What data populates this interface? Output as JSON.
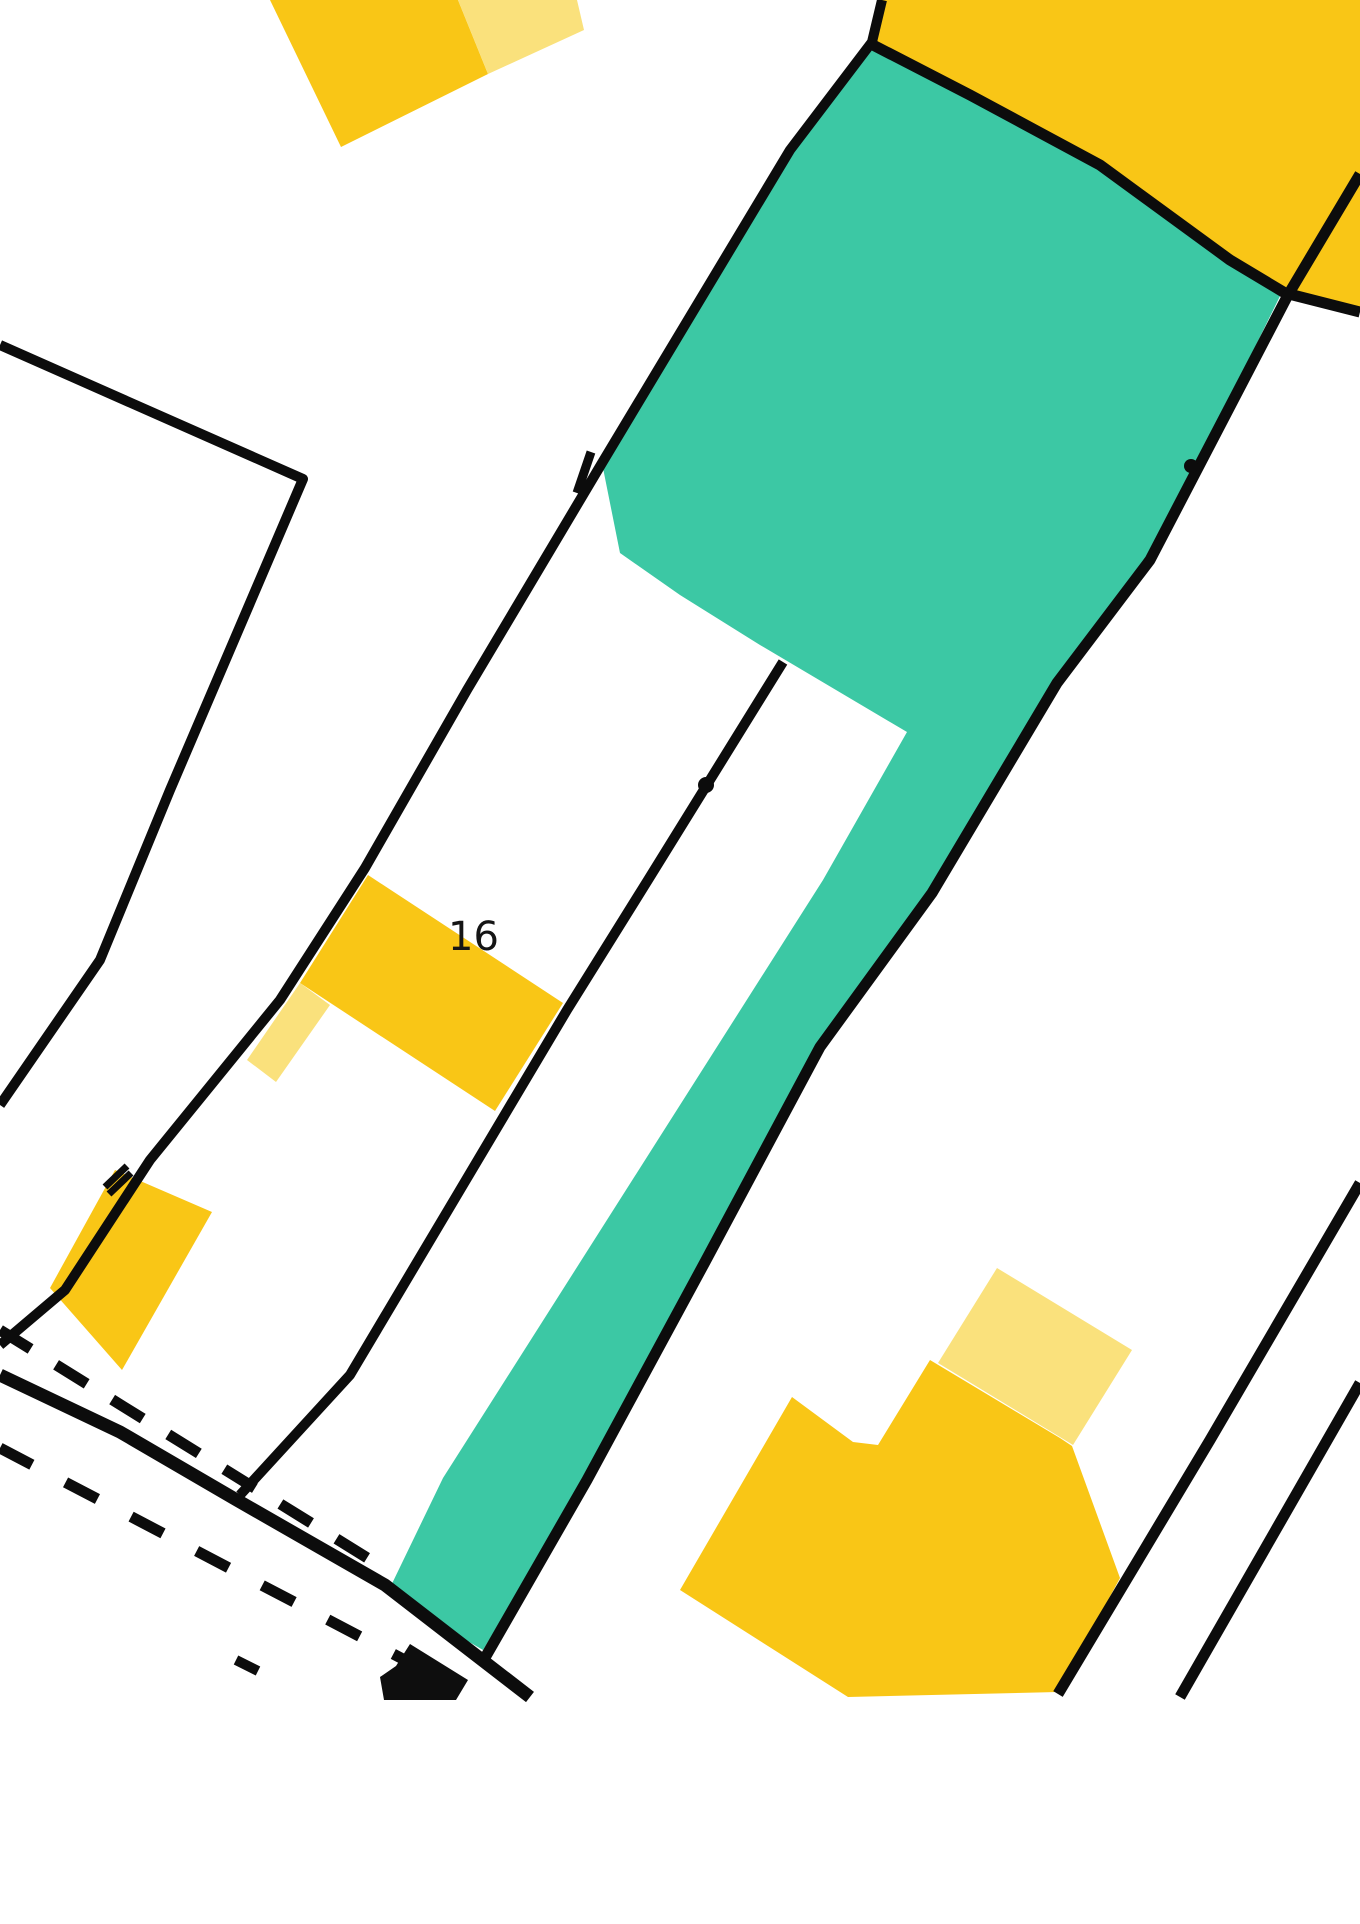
{
  "map": {
    "canvas": {
      "width": 1360,
      "height": 1924,
      "background": "#ffffff"
    },
    "palette": {
      "boundary_black": "#0c0c0c",
      "highlight_teal": "#3cc8a4",
      "building_yellow": "#f9c616",
      "building_yellow_light": "#fae17c",
      "building_black": "#0e0e0e",
      "label_color": "#151515"
    },
    "label": {
      "text": "16",
      "x": 448,
      "y": 950,
      "font_size": 40
    },
    "regions_under": [
      {
        "name": "highlight-parcel-teal",
        "fill": "highlight_teal",
        "points": [
          [
            873,
            45
          ],
          [
            970,
            95
          ],
          [
            1100,
            165
          ],
          [
            1230,
            260
          ],
          [
            1282,
            292
          ],
          [
            1150,
            560
          ],
          [
            1057,
            683
          ],
          [
            932,
            893
          ],
          [
            820,
            1047
          ],
          [
            705,
            1262
          ],
          [
            585,
            1480
          ],
          [
            483,
            1650
          ],
          [
            387,
            1594
          ],
          [
            443,
            1478
          ],
          [
            823,
            880
          ],
          [
            907,
            732
          ],
          [
            760,
            645
          ],
          [
            680,
            595
          ],
          [
            620,
            553
          ],
          [
            602,
            463
          ],
          [
            790,
            150
          ],
          [
            872,
            42
          ]
        ]
      },
      {
        "name": "building-top-right-yellow",
        "fill": "building_yellow",
        "points": [
          [
            810,
            0
          ],
          [
            1360,
            0
          ],
          [
            1360,
            312
          ],
          [
            1285,
            293
          ],
          [
            1230,
            260
          ],
          [
            1100,
            165
          ],
          [
            970,
            95
          ],
          [
            873,
            45
          ],
          [
            872,
            42
          ],
          [
            882,
            0
          ]
        ]
      },
      {
        "name": "building-top-left-yellow",
        "fill": "building_yellow",
        "points": [
          [
            270,
            0
          ],
          [
            458,
            0
          ],
          [
            488,
            74
          ],
          [
            341,
            147
          ]
        ]
      },
      {
        "name": "building-top-left-annex-light",
        "fill": "building_yellow_light",
        "points": [
          [
            458,
            0
          ],
          [
            577,
            0
          ],
          [
            584,
            30
          ],
          [
            488,
            74
          ]
        ]
      },
      {
        "name": "building-16-yellow",
        "fill": "building_yellow",
        "points": [
          [
            368,
            875
          ],
          [
            563,
            1003
          ],
          [
            495,
            1111
          ],
          [
            300,
            983
          ]
        ]
      },
      {
        "name": "building-16-annex-light",
        "fill": "building_yellow_light",
        "points": [
          [
            300,
            983
          ],
          [
            330,
            1005
          ],
          [
            276,
            1082
          ],
          [
            247,
            1060
          ]
        ]
      },
      {
        "name": "building-bottom-left-yellow",
        "fill": "building_yellow",
        "points": [
          [
            115,
            1170
          ],
          [
            212,
            1212
          ],
          [
            122,
            1370
          ],
          [
            50,
            1288
          ]
        ]
      },
      {
        "name": "building-bottom-right-yellow",
        "fill": "building_yellow",
        "points": [
          [
            792,
            1397
          ],
          [
            853,
            1442
          ],
          [
            878,
            1445
          ],
          [
            930,
            1360
          ],
          [
            1060,
            1438
          ],
          [
            1072,
            1446
          ],
          [
            1120,
            1578
          ],
          [
            1058,
            1692
          ],
          [
            848,
            1697
          ],
          [
            680,
            1590
          ]
        ]
      },
      {
        "name": "building-bottom-right-annex-light",
        "fill": "building_yellow_light",
        "points": [
          [
            997,
            1268
          ],
          [
            1132,
            1350
          ],
          [
            1073,
            1445
          ],
          [
            938,
            1363
          ]
        ]
      }
    ],
    "lines": [
      {
        "name": "parcel-line-left-of-teal",
        "width": 10,
        "points": [
          [
            882,
            0
          ],
          [
            872,
            42
          ],
          [
            790,
            150
          ],
          [
            602,
            463
          ],
          [
            467,
            690
          ],
          [
            365,
            868
          ],
          [
            280,
            1000
          ],
          [
            150,
            1160
          ],
          [
            65,
            1290
          ],
          [
            0,
            1345
          ]
        ]
      },
      {
        "name": "parcel-line-yellow-block-bottom",
        "width": 11,
        "points": [
          [
            872,
            42
          ],
          [
            873,
            45
          ],
          [
            970,
            95
          ],
          [
            1100,
            165
          ],
          [
            1230,
            260
          ],
          [
            1285,
            293
          ],
          [
            1360,
            312
          ]
        ]
      },
      {
        "name": "parcel-line-right-of-teal",
        "width": 11,
        "points": [
          [
            1360,
            174
          ],
          [
            1288,
            295
          ],
          [
            1150,
            560
          ],
          [
            1057,
            683
          ],
          [
            932,
            893
          ],
          [
            820,
            1047
          ],
          [
            705,
            1262
          ],
          [
            587,
            1480
          ],
          [
            486,
            1656
          ]
        ]
      },
      {
        "name": "parcel-line-center",
        "width": 10,
        "points": [
          [
            783,
            662
          ],
          [
            648,
            880
          ],
          [
            567,
            1010
          ],
          [
            460,
            1190
          ],
          [
            350,
            1375
          ],
          [
            240,
            1495
          ]
        ]
      },
      {
        "name": "parcel-line-left-chevron",
        "width": 10,
        "points": [
          [
            0,
            345
          ],
          [
            303,
            479
          ],
          [
            170,
            790
          ],
          [
            100,
            960
          ],
          [
            0,
            1105
          ]
        ]
      },
      {
        "name": "road-edge-line",
        "width": 13,
        "points": [
          [
            0,
            1375
          ],
          [
            120,
            1432
          ],
          [
            235,
            1499
          ],
          [
            385,
            1585
          ],
          [
            530,
            1697
          ]
        ]
      },
      {
        "name": "parcel-line-bottom-right-1",
        "width": 11,
        "points": [
          [
            1360,
            1183
          ],
          [
            1210,
            1440
          ],
          [
            1058,
            1694
          ]
        ]
      },
      {
        "name": "parcel-line-bottom-right-2",
        "width": 11,
        "points": [
          [
            1360,
            1383
          ],
          [
            1180,
            1697
          ]
        ]
      },
      {
        "name": "dashed-boundary-upper",
        "width": 11,
        "dash": "36 30",
        "points": [
          [
            0,
            1330
          ],
          [
            390,
            1572
          ]
        ]
      },
      {
        "name": "dashed-boundary-lower",
        "width": 11,
        "dash": "36 38",
        "points": [
          [
            0,
            1448
          ],
          [
            420,
            1668
          ]
        ]
      },
      {
        "name": "dash-fragment",
        "width": 10,
        "points": [
          [
            236,
            1660
          ],
          [
            258,
            1671
          ]
        ]
      },
      {
        "name": "boundary-tick-center",
        "width": 9,
        "points": [
          [
            591,
            452
          ],
          [
            577,
            493
          ]
        ]
      },
      {
        "name": "boundary-tick-left-a",
        "width": 7,
        "points": [
          [
            105,
            1187
          ],
          [
            127,
            1166
          ]
        ]
      },
      {
        "name": "boundary-tick-left-b",
        "width": 7,
        "points": [
          [
            109,
            1194
          ],
          [
            131,
            1173
          ]
        ]
      }
    ],
    "regions_over": [
      {
        "name": "building-black-footprint",
        "fill": "building_black",
        "points": [
          [
            410,
            1644
          ],
          [
            468,
            1680
          ],
          [
            456,
            1700
          ],
          [
            384,
            1700
          ],
          [
            380,
            1677
          ],
          [
            396,
            1666
          ]
        ]
      }
    ],
    "dots": [
      {
        "name": "boundary-point-dot-center",
        "cx": 706,
        "cy": 785,
        "r": 8
      },
      {
        "name": "boundary-point-dot-right",
        "cx": 1191,
        "cy": 466,
        "r": 7
      }
    ]
  }
}
